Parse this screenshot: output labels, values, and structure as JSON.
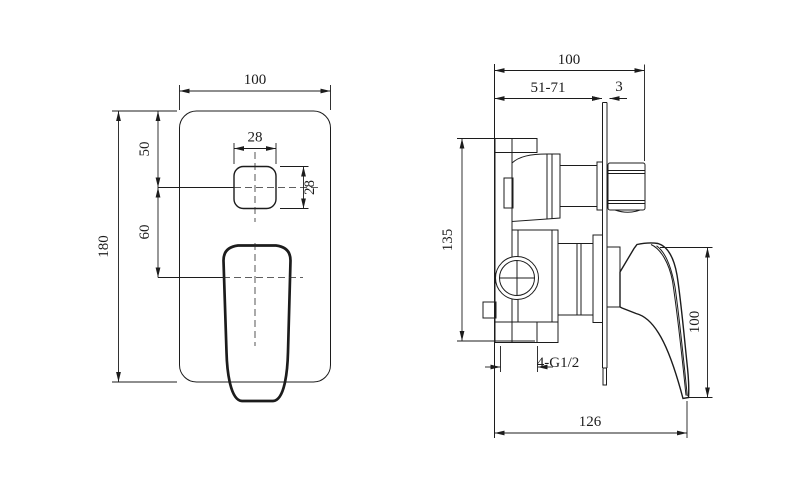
{
  "drawing_title": "shower-mixer-valve-technical-drawing",
  "front_view": {
    "plate_width": "100",
    "plate_height": "180",
    "button_offset_top": "50",
    "button_to_handle": "60",
    "button_width": "28",
    "button_height": "28"
  },
  "side_view": {
    "overall_depth": "100",
    "install_depth_range": "51-71",
    "plate_thickness": "3",
    "body_height": "135",
    "handle_height": "100",
    "overall_projection": "126",
    "inlet_thread": "4-G1/2"
  },
  "colors": {
    "line": "#1c1c1c",
    "background": "#ffffff"
  }
}
